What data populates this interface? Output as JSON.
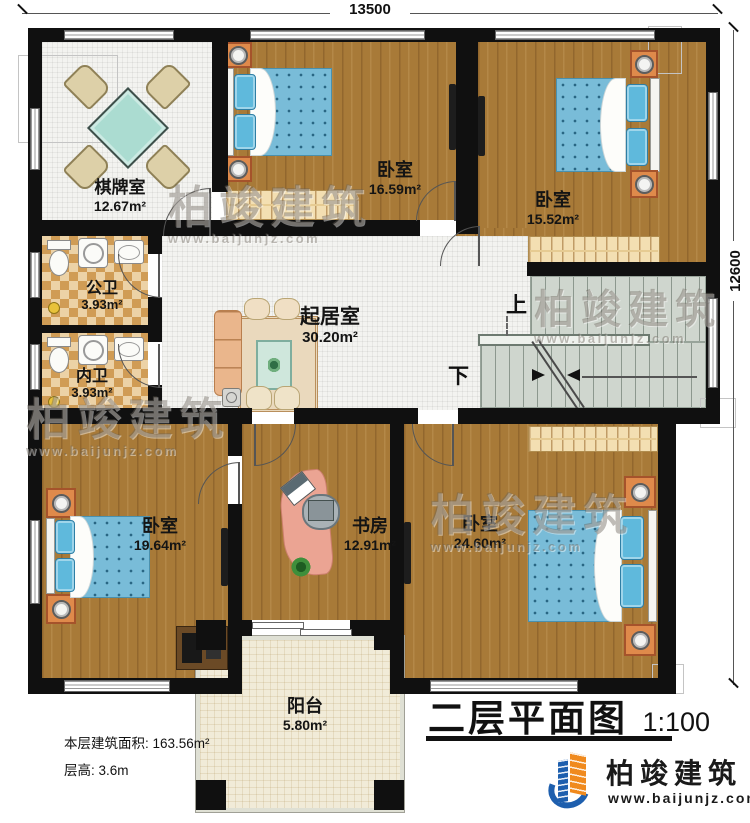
{
  "title_block": {
    "name": "二层平面图",
    "scale": "1:100"
  },
  "dimensions": {
    "top": "13500",
    "right": "12600"
  },
  "rooms": [
    {
      "name": "棋牌室",
      "area": "12.67m²"
    },
    {
      "name": "卧室",
      "area": "16.59m²"
    },
    {
      "name": "卧室",
      "area": "15.52m²"
    },
    {
      "name": "公卫",
      "area": "3.93m²"
    },
    {
      "name": "内卫",
      "area": "3.93m²"
    },
    {
      "name": "起居室",
      "area": "30.20m²"
    },
    {
      "name": "卧室",
      "area": "19.64m²"
    },
    {
      "name": "书房",
      "area": "12.91m²"
    },
    {
      "name": "卧室",
      "area": "24.60m²"
    },
    {
      "name": "阳台",
      "area": "5.80m²"
    }
  ],
  "stairs": {
    "up_label": "上",
    "down_label": "下"
  },
  "notes": {
    "floor_area": "本层建筑面积: 163.56m²",
    "floor_height": "层高: 3.6m"
  },
  "branding": {
    "company": "柏竣建筑",
    "website": "www.baijunjz.com"
  },
  "watermark": {
    "text": "柏竣建筑",
    "url": "www.baijunjz.com"
  },
  "colors": {
    "wall": "#101010",
    "wood_floor": "#a87a38",
    "tile_floor": "#f3f3f0",
    "bath_tile": "#d09c55",
    "stair_floor": "#cfd6ce",
    "balcony_floor": "#f1ebd8",
    "bed_blue": "#79bcd8",
    "furniture_orange": "#df8a4b",
    "table_teal": "#abdcd1",
    "logo_blue": "#1e5fae",
    "logo_orange": "#f08a1e"
  }
}
